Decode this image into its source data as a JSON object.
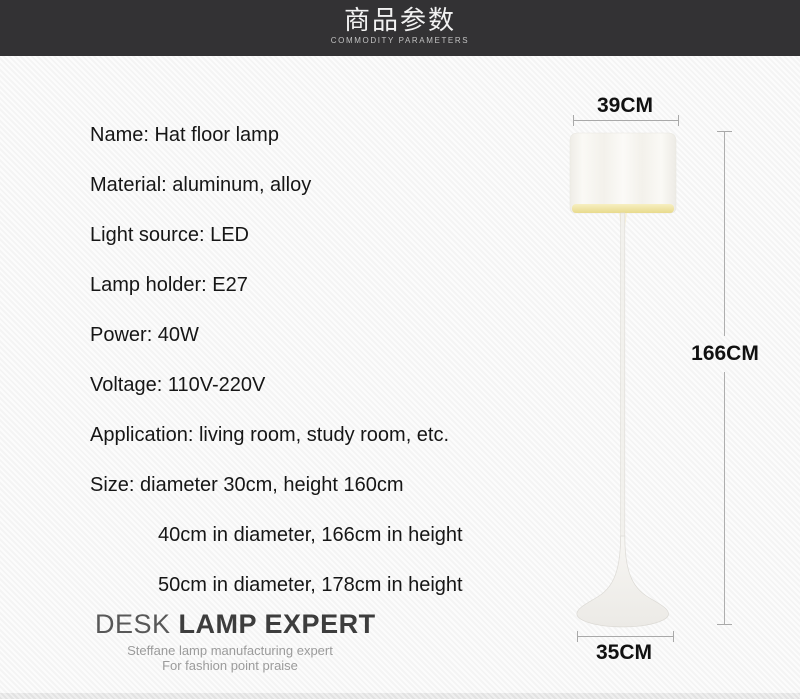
{
  "header": {
    "title": "商品参数",
    "subtitle": "COMMODITY PARAMETERS"
  },
  "specs": [
    {
      "text": "Name: Hat floor lamp"
    },
    {
      "text": "Material: aluminum, alloy"
    },
    {
      "text": "Light source: LED"
    },
    {
      "text": "Lamp holder: E27"
    },
    {
      "text": "Power: 40W"
    },
    {
      "text": "Voltage: 110V-220V"
    },
    {
      "text": "Application: living room, study room, etc."
    },
    {
      "text": "Size: diameter 30cm, height 160cm"
    },
    {
      "text": "40cm in diameter, 166cm in height"
    },
    {
      "text": "50cm in diameter, 178cm in height"
    }
  ],
  "logo": {
    "brand_prefix": "DESK ",
    "brand_main": "LAMP EXPERT",
    "tagline_line1": "Steffane lamp manufacturing expert",
    "tagline_line2": "For fashion point praise"
  },
  "lamp_dimensions": {
    "shade_width": "39CM",
    "total_height": "166CM",
    "base_width": "35CM"
  },
  "colors": {
    "header_bg": "#333234",
    "spec_text": "#161616",
    "dimension_line": "#a9a9a9",
    "dimension_label": "#111111",
    "logo_text": "#3d3d3d",
    "tagline_text": "#9b9b9b",
    "shade_body": "#f5f3ee",
    "shade_glow": "#ecdf9d",
    "lamp_base": "#f1f0ed"
  }
}
